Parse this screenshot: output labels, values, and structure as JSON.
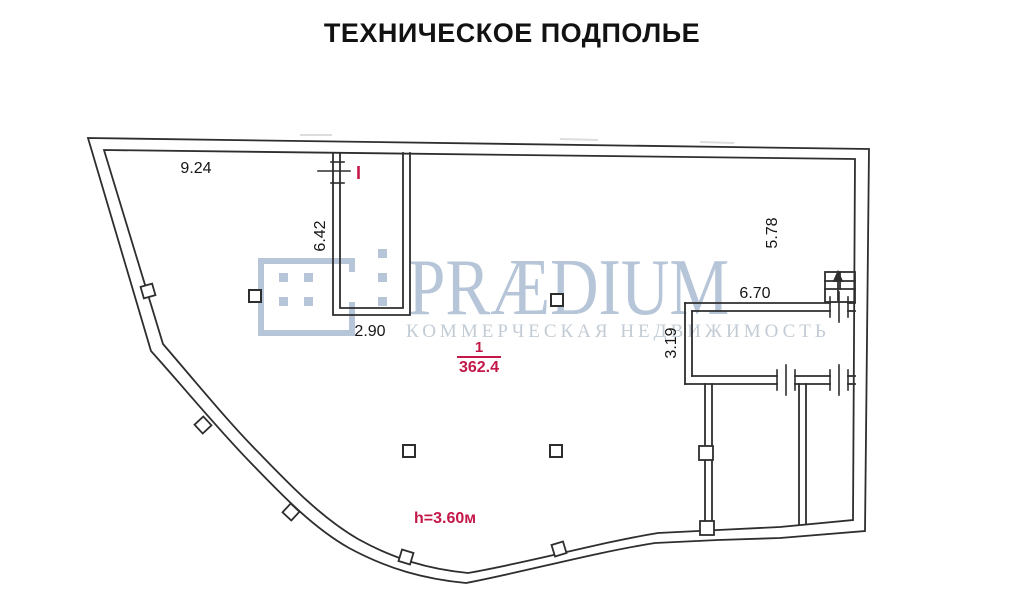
{
  "title": "ТЕХНИЧЕСКОЕ ПОДПОЛЬЕ",
  "watermark": {
    "brand": "PRÆDIUM",
    "tagline": "КОММЕРЧЕСКАЯ НЕДВИЖИМОСТЬ",
    "brand_color": "#b6c5d8",
    "tagline_color": "#c3ccd5"
  },
  "plan": {
    "line_color": "#2e2e2e",
    "accent_color": "#c41849",
    "room": {
      "number": "1",
      "area": "362.4"
    },
    "ceiling_height_label": "h=3.60м",
    "entry_mark": "I",
    "dimensions": [
      {
        "id": "top-wall-width",
        "value": "9.24",
        "orientation": "horizontal"
      },
      {
        "id": "shaft-depth",
        "value": "6.42",
        "orientation": "vertical"
      },
      {
        "id": "shaft-width",
        "value": "2.90",
        "orientation": "horizontal"
      },
      {
        "id": "right-area-depth",
        "value": "5.78",
        "orientation": "vertical"
      },
      {
        "id": "right-room-width",
        "value": "6.70",
        "orientation": "horizontal"
      },
      {
        "id": "right-room-height",
        "value": "3.19",
        "orientation": "vertical"
      }
    ]
  }
}
